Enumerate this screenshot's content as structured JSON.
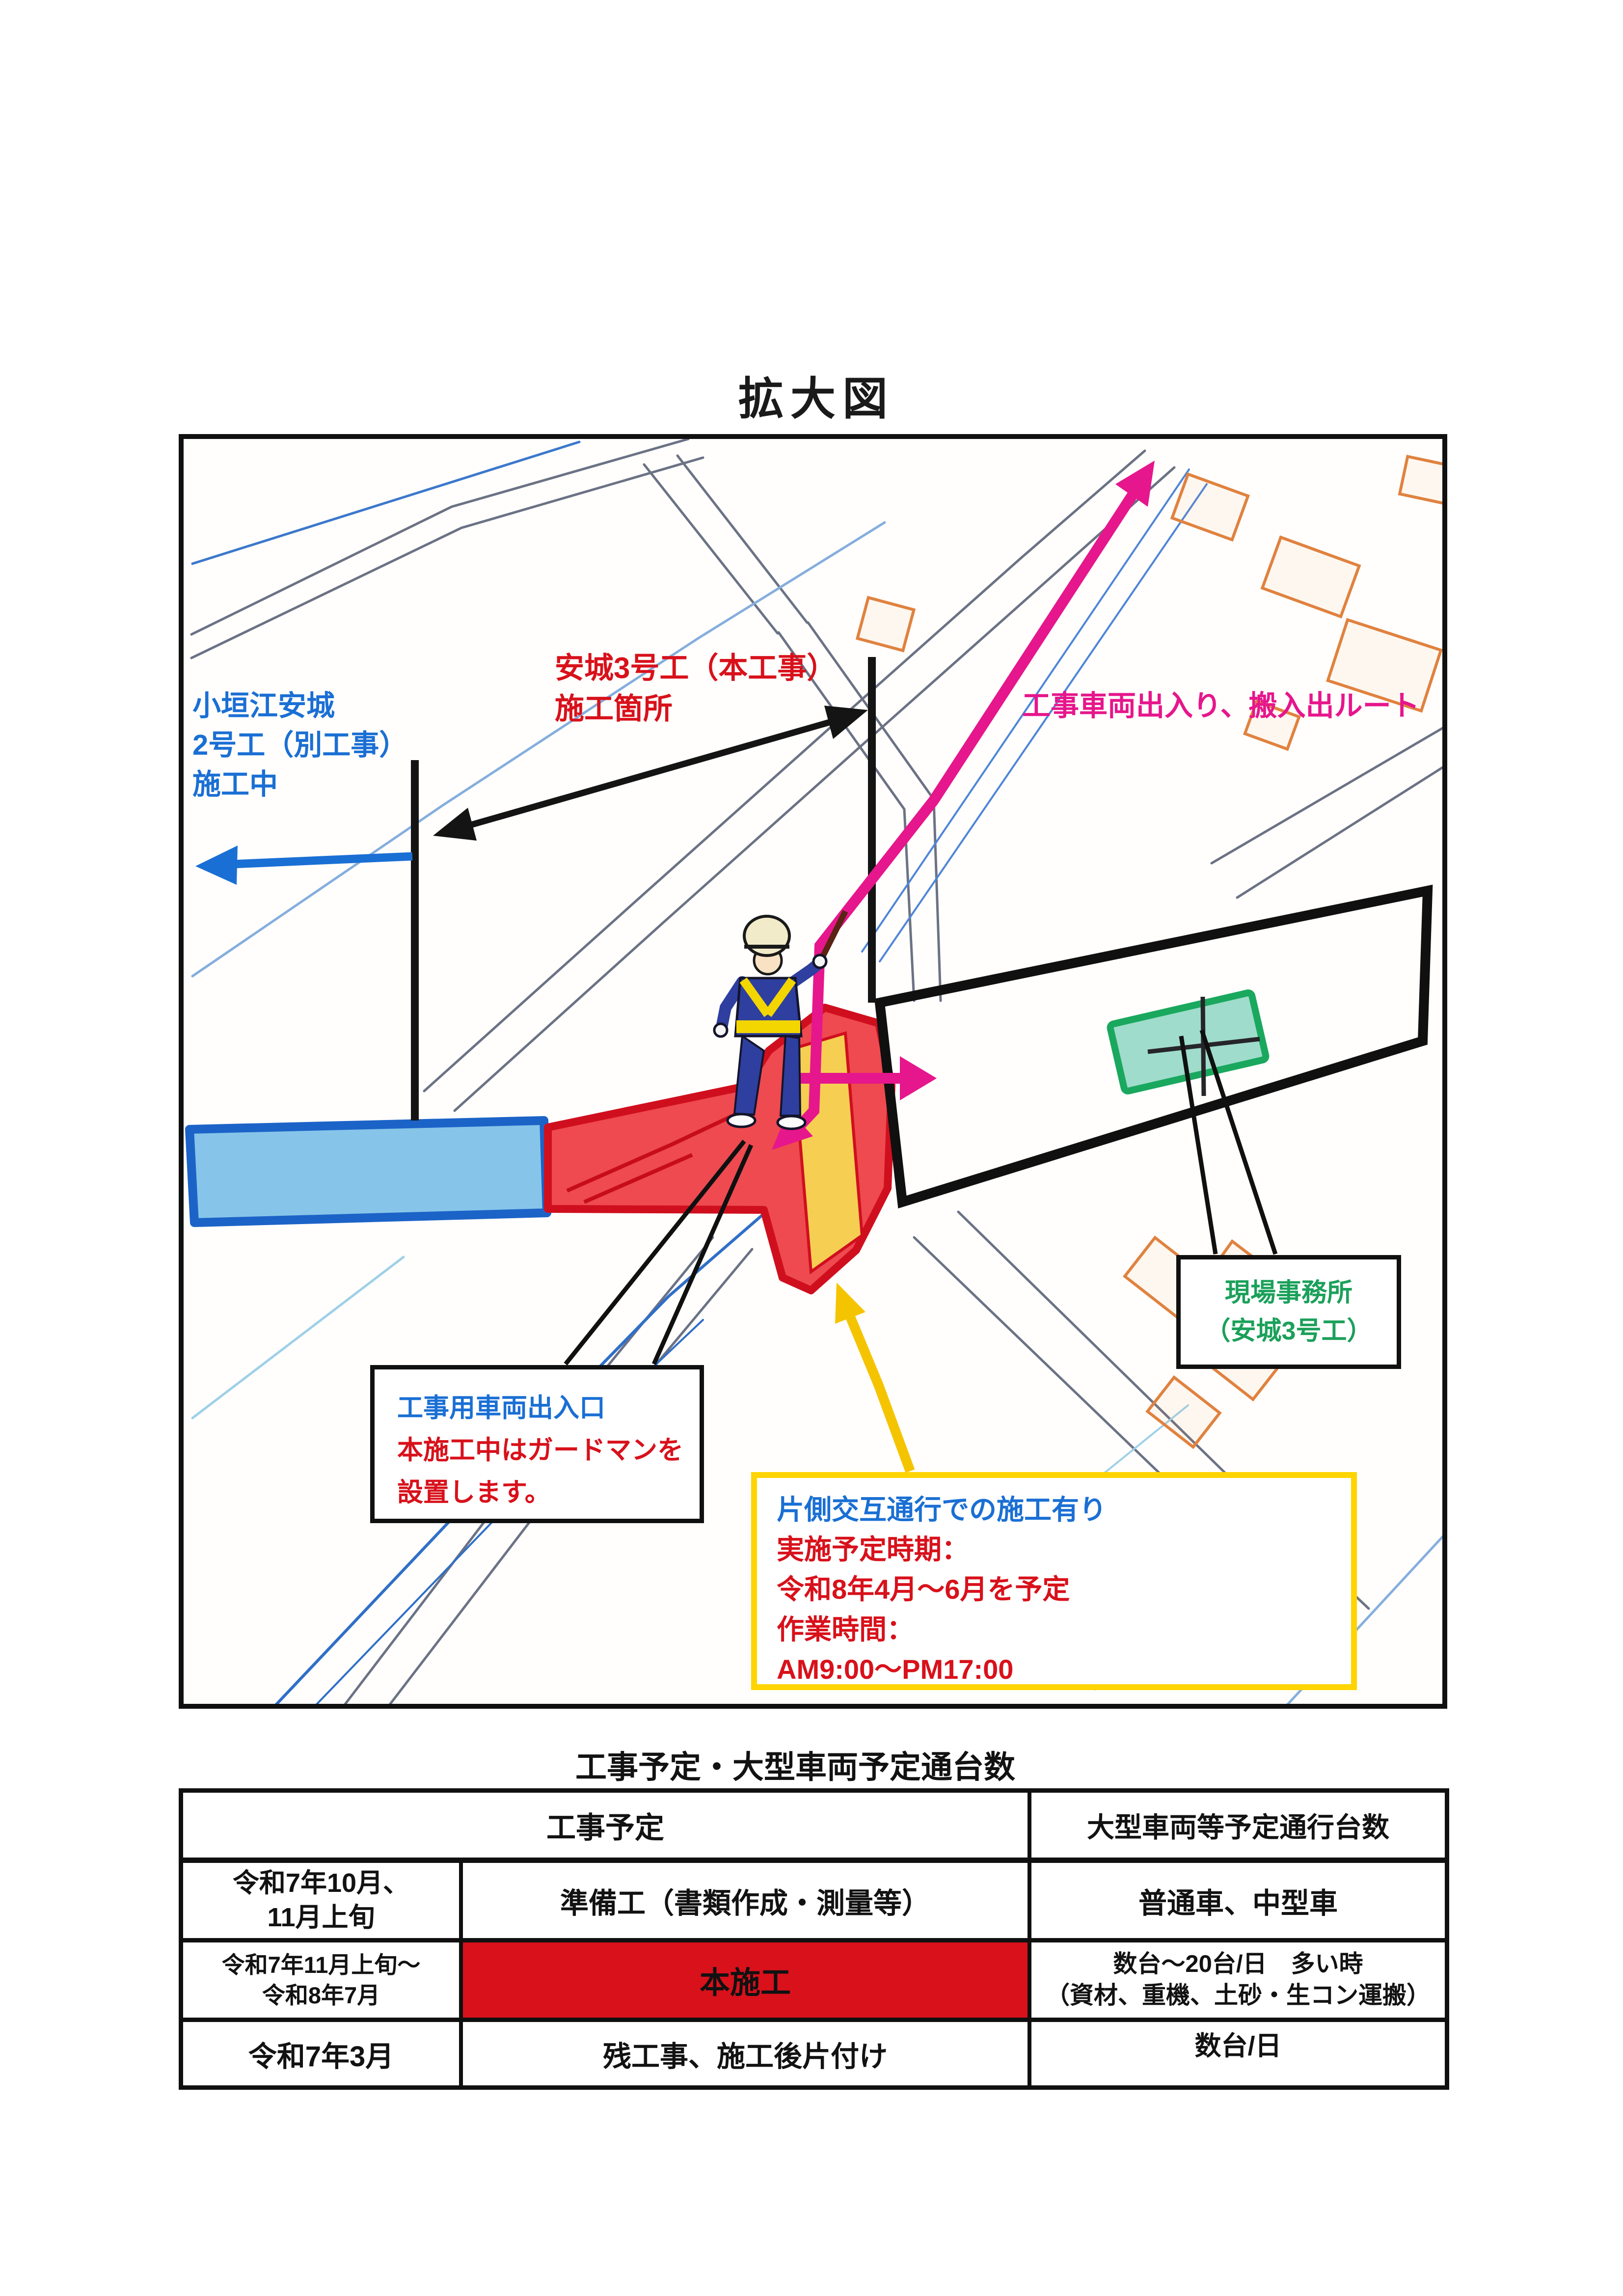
{
  "page": {
    "title": "拡大図"
  },
  "colors": {
    "accent_red": "#d8111b",
    "accent_blue": "#1a6fd4",
    "accent_magenta": "#e6168c",
    "accent_green": "#1ba05a",
    "accent_yellow": "#ffd400",
    "zone_red_fill": "#ee4a50",
    "zone_blue_fill": "#86c5e9",
    "zone_yellow_fill": "#f6cf52",
    "zone_green_fill": "#9fdccb"
  },
  "map": {
    "labels": {
      "other_project": {
        "text": "小垣江安城\n2号工（別工事）\n施工中"
      },
      "main_project": {
        "text": "安城3号工（本工事）\n施工箇所"
      },
      "route": {
        "text": "工事車両出入り、搬入出ルート"
      },
      "office": {
        "text": "現場事務所\n（安城3号工）"
      }
    },
    "callouts": {
      "entrance": {
        "line_blue": "工事用車両出入口",
        "lines_red": "本施工中はガードマンを\n設置します。"
      },
      "oneway": {
        "line_blue": "片側交互通行での施工有り",
        "lines_red": "実施予定時期：\n令和8年4月～6月を予定\n作業時間：\nAM9:00～PM17:00"
      }
    }
  },
  "table": {
    "title": "工事予定・大型車両予定通台数",
    "header_left": "工事予定",
    "header_right": "大型車両等予定通行台数",
    "rows": [
      {
        "period": "令和7年10月、\n11月上旬",
        "work": "準備工（書類作成・測量等）",
        "traffic": "普通車、中型車"
      },
      {
        "period": "令和7年11月上旬～\n令和8年7月",
        "work": "本施工",
        "traffic": "数台～20台/日　多い時\n（資材、重機、土砂・生コン運搬）"
      },
      {
        "period": "令和7年3月",
        "work": "残工事、施工後片付け",
        "traffic": "数台/日"
      }
    ]
  }
}
